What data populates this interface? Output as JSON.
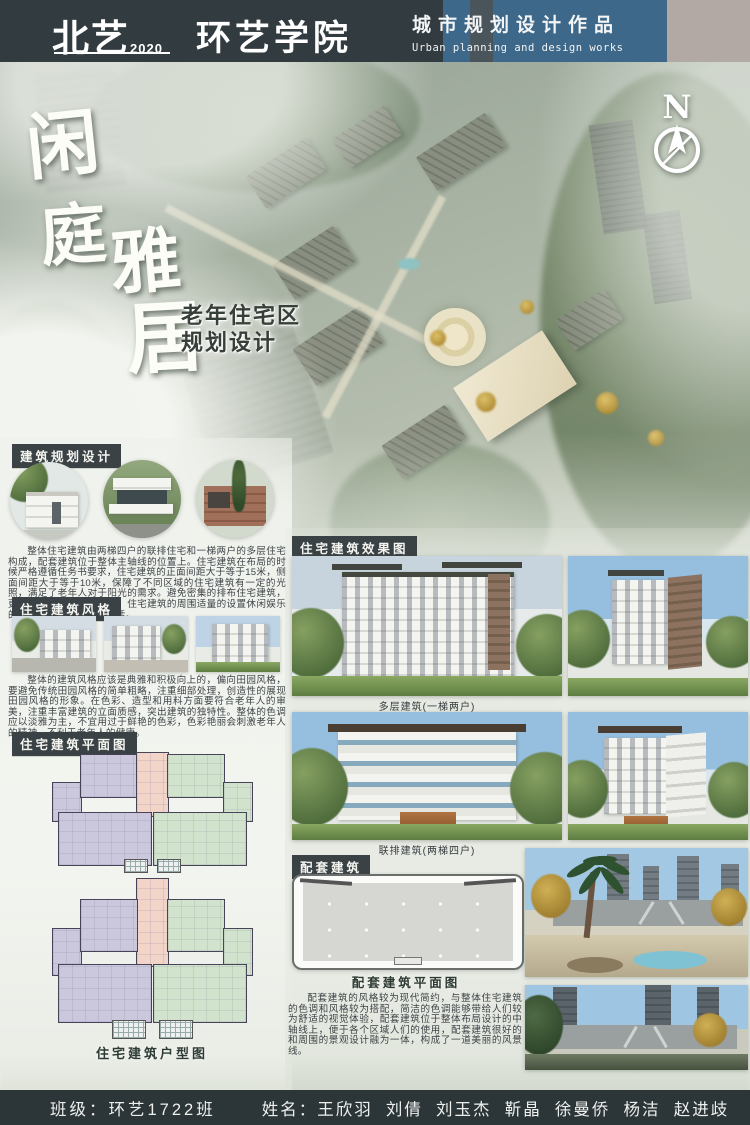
{
  "header": {
    "school_name": "北艺",
    "year": "2020",
    "college_name": "环艺学院",
    "work_type_cn": "城市规划设计作品",
    "work_type_en": "Urban planning and design works"
  },
  "hero": {
    "title_chars": [
      "闲",
      "庭",
      "雅",
      "居"
    ],
    "subtitle_line1": "老年住宅区",
    "subtitle_line2": "规划设计",
    "north_label": "N"
  },
  "sections": {
    "planning": {
      "header": "建筑规划设计",
      "paragraph": "整体住宅建筑由两梯四户的联排住宅和一梯两户的多层住宅构成，配套建筑位于整体主轴线的位置上。住宅建筑在布局的时候严格遵循任务书要求，住宅建筑的正面间距大于等于15米，侧面间距大于等于10米，保障了不同区域的住宅建筑有一定的光照，满足了老年人对于阳光的需求。避免密集的排布住宅建筑，更注重空间舒适感的营造，住宅建筑的周围适量的设置休闲娱乐的区域，丰富老年人的生活。"
    },
    "style": {
      "header": "住宅建筑风格",
      "paragraph": "整体的建筑风格应该是典雅和积极向上的，偏向田园风格，要避免传统田园风格的简单粗略，注重细部处理，创造性的展现田园风格的形象。在色彩、造型和用料方面要符合老年人的审美，注重丰富建筑的立面质感，突出建筑的独特性。整体的色调应以淡雅为主，不宜用过于鲜艳的色彩，色彩艳丽会刺激老年人的精神，不利于老年人的健康。"
    },
    "floor_plans": {
      "header": "住宅建筑平面图",
      "caption": "住宅建筑户型图"
    },
    "renderings": {
      "header": "住宅建筑效果图",
      "label_multistory": "多层建筑(一梯两户)",
      "label_townhouse": "联排建筑(两梯四户)"
    },
    "amenity": {
      "header": "配套建筑",
      "plan_caption": "配套建筑平面图",
      "paragraph": "配套建筑的风格较为现代简约，与整体住宅建筑的色调和风格较为搭配，简洁的色调能够带给人们较为舒适的视觉体验，配套建筑位于整体布局设计的中轴线上，便于各个区域人们的使用，配套建筑很好的和周围的景观设计融为一体，构成了一道美丽的风景线。"
    }
  },
  "footer": {
    "class_label": "班级：环艺1722班",
    "names_label": "姓名：王欣羽  刘倩  刘玉杰  靳晶  徐曼侨  杨洁  赵进歧"
  },
  "colors": {
    "header_bg": "#323b3f",
    "header_blue": "#3d6889",
    "header_beige": "#b2a8a4",
    "footer_bg": "#2c3538",
    "section_header_bg": "#3a4245",
    "plan_purple": "#cbc8dd",
    "plan_pink": "#f2d4c9",
    "plan_green": "#d1e3cc"
  }
}
